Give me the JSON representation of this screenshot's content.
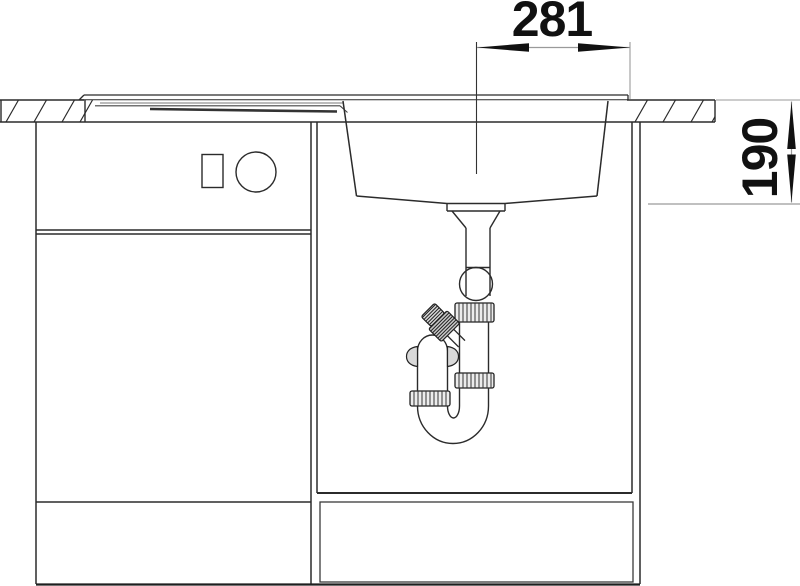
{
  "drawing": {
    "title": "sink-cabinet-installation-side-view",
    "dimensions": {
      "width": {
        "value": "281"
      },
      "depth": {
        "value": "190"
      }
    },
    "colors": {
      "background": "#ffffff",
      "line": "#2b2b2b",
      "dimension_line": "#9a9a9a",
      "dimension_text": "#111111",
      "nut_fill": "#ececec",
      "branch_nut_fill": "#c8c8c8"
    }
  }
}
